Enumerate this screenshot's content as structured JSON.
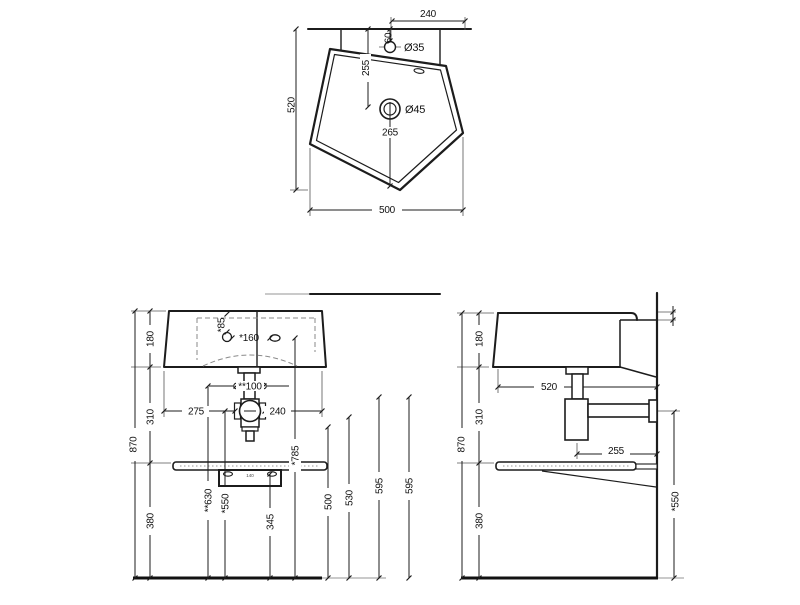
{
  "palette": {
    "line": "#1c1c1c",
    "dashed_line": "#8a8a8a",
    "light_gray": "#b8b8b8",
    "background": "#ffffff"
  },
  "top_view": {
    "labels": {
      "w240": "240",
      "d60": "60",
      "dia35": "Ø35",
      "d255": "255",
      "dia45": "Ø45",
      "d265": "265",
      "h520": "520",
      "w500": "500"
    }
  },
  "front_view": {
    "labels": {
      "h180": "180",
      "a85": "*85",
      "a160": "*160",
      "a100": "**100",
      "w275": "275",
      "w240": "240",
      "h310": "310",
      "h870": "870",
      "a785": "*785",
      "a630": "**630",
      "a550": "*550",
      "h345": "345",
      "h500": "500",
      "h530": "530",
      "h595a": "595",
      "h595b": "595",
      "h380": "380",
      "bracket": "140"
    }
  },
  "side_view": {
    "labels": {
      "h180": "180",
      "d520": "520",
      "h310": "310",
      "h870": "870",
      "d255": "255",
      "h380": "380",
      "a550": "*550"
    }
  }
}
